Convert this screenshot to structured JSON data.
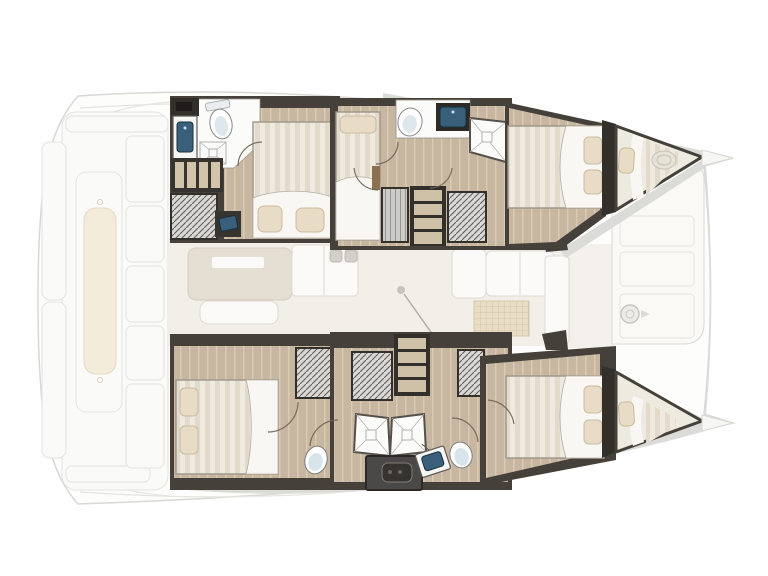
{
  "diagram": {
    "type": "yacht-floorplan",
    "vessel": "Catamaran interior layout, top-down view, bow pointing right",
    "text_labels": []
  },
  "floorplan": {
    "cockpit": {
      "label": "Aft cockpit deck (ghosted) with bench seat and side lockers"
    },
    "saloon": {
      "label": "Central saloon and galley (ghosted)",
      "items": {
        "island": "galley island counter",
        "sofa": "saloon bench seat",
        "cabinet": "galley cabinet with twin handles",
        "settee": "forward settee",
        "mat": "galley floor mat",
        "door": "sliding door with swing line"
      }
    },
    "foredeck": {
      "label": "Foredeck lounge panel (ghosted) with winch"
    },
    "hulls": {
      "upper": {
        "label": "Upper hull accommodation"
      },
      "lower": {
        "label": "Lower hull accommodation"
      }
    },
    "cabins": {
      "upper_aft": {
        "label": "Upper aft cabin: double berth, bathroom with toilet, sink, shower, steps, wardrobe, desk"
      },
      "upper_mid": {
        "label": "Upper mid cabin: single berth, bathroom with toilet, sink and shower, companionway stairs, wardrobes"
      },
      "upper_bow": {
        "label": "Upper bow cabin: double berth with two pillows"
      },
      "upper_peak": {
        "label": "Upper forepeak berth with pillow and deck hatch"
      },
      "lower_aft": {
        "label": "Lower aft cabin: double berth, wardrobe, toilet and sink"
      },
      "lower_mid": {
        "label": "Lower mid area: companionway stairs, wardrobes, twin shower stalls, twin sinks, two toilets, engine module"
      },
      "lower_bow": {
        "label": "Lower bow cabin: double berth with two pillows"
      },
      "lower_peak": {
        "label": "Lower forepeak berth with pillow"
      }
    },
    "fixture_counts": {
      "double_berths": 4,
      "forepeak_berths": 2,
      "toilets": 4,
      "sinks": 4,
      "showers": 4,
      "companionway_stairs": 2,
      "wardrobes": 6
    }
  },
  "colors": {
    "background": "#ffffff",
    "ghost_outline": "#d9d8d5",
    "wall_dark": "#46403a",
    "wall_darker": "#332f2b",
    "wood_floor": "#c8b7a0",
    "wood_plank_line": "#d8cab3",
    "mattress_stripe_light": "#efe9df",
    "mattress_stripe_dark": "#e2dacb",
    "duvet_white": "#f9f7f3",
    "pillow_beige": "#e8dcc6",
    "sink_navy": "#3a5f7a",
    "toilet_blue": "#d7e4ea",
    "wardrobe_gray": "#d8d8d7",
    "deck_band_gray": "#dbdbd8",
    "cushion_cream": "#f3ecdb"
  }
}
